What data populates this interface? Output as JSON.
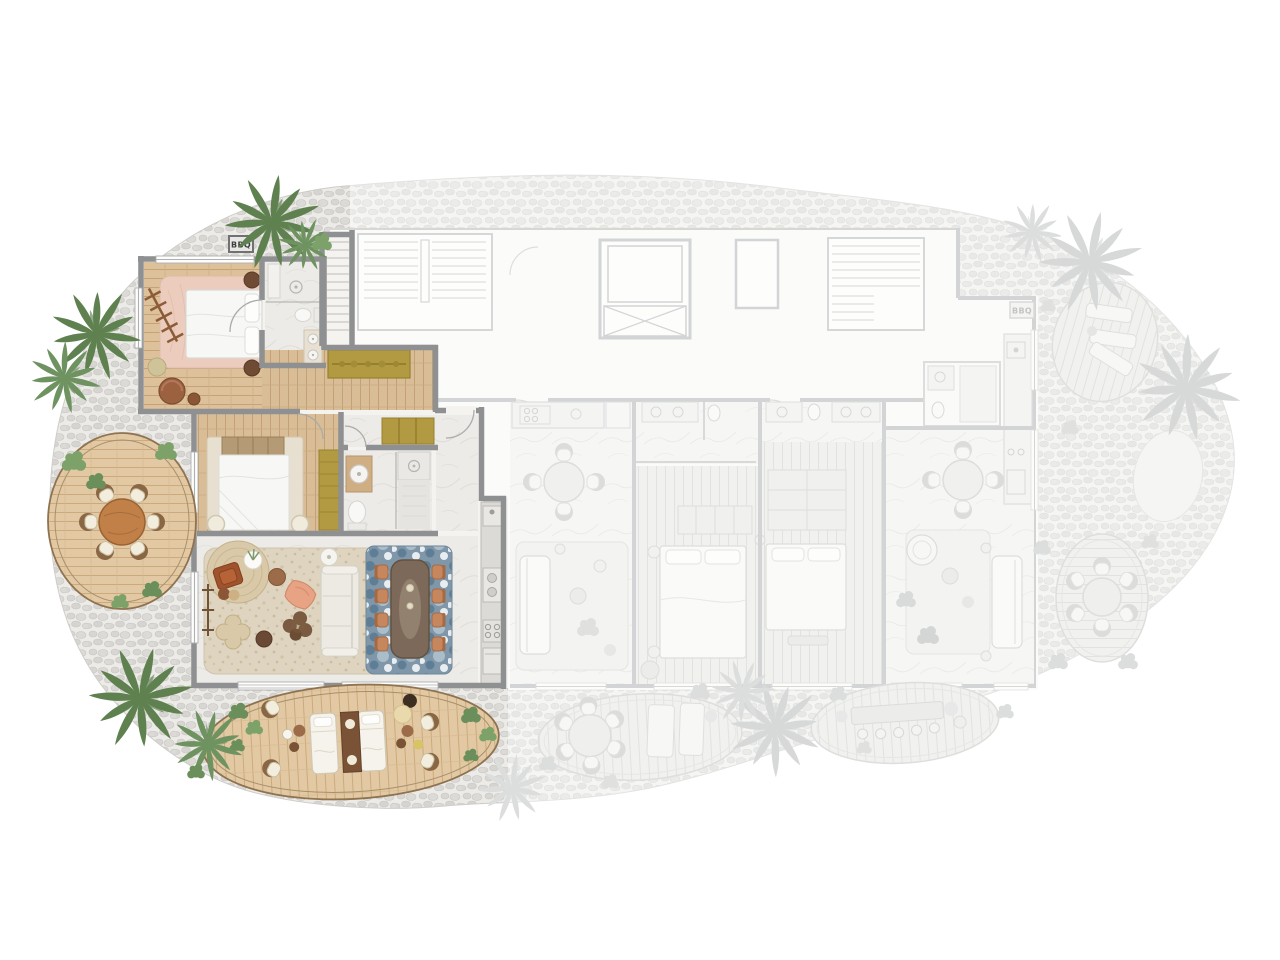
{
  "scene": {
    "type": "architectural floor plan",
    "view": "top-down",
    "description": "Resort residence floor plan: one highlighted corner suite with two bedrooms, two bathrooms, living-dining room, kitchen and two private wooden decks; adjacent units and circulation core shown grayed out."
  },
  "labels": {
    "bbq_left": "BBQ",
    "bbq_right": "BBQ"
  },
  "palette": {
    "wall": "#8e9091",
    "faded_wall": "#d2d4d5",
    "wood_floor": "#dcc19b",
    "deck_wood": "#e2c9a3",
    "marble": "#edebe7",
    "pebble_stone": "#d8d6d2",
    "faded_stone": "#e9e9e7",
    "rug_pink": "#eccdbd",
    "rug_beige": "#ded4c0",
    "rug_blue": "#7e97ab",
    "wardrobe_olive": "#b29a43",
    "chair_orange": "#c6875f",
    "table_walnut": "#7d695a",
    "palm_green": "#5f8150",
    "palm_faded": "#d7d9d8"
  },
  "highlighted_unit": {
    "rooms": [
      {
        "name": "Master bedroom",
        "furniture": [
          "double bed",
          "pink area rug",
          "two bedside tables",
          "lounge chair",
          "side table",
          "pouf",
          "decorative ladder"
        ]
      },
      {
        "name": "Master bathroom",
        "furniture": [
          "walk-in shower",
          "bench",
          "toilet",
          "double vanity"
        ]
      },
      {
        "name": "Dressing corridor",
        "furniture": [
          "olive wardrobe"
        ]
      },
      {
        "name": "Second bedroom",
        "furniture": [
          "double bed",
          "headboard cushions",
          "two round stools",
          "olive wardrobe"
        ]
      },
      {
        "name": "Second bathroom",
        "furniture": [
          "wood vanity with basin",
          "toilet",
          "shower with drain"
        ]
      },
      {
        "name": "Entry foyer",
        "furniture": [
          "olive closet"
        ]
      },
      {
        "name": "Living room",
        "furniture": [
          "cream sofa",
          "round jute rug",
          "rust armchair",
          "plant table",
          "floor lamp",
          "ottomans",
          "clover coffee tables",
          "wooden bench",
          "beige area rug"
        ]
      },
      {
        "name": "Dining area",
        "furniture": [
          "walnut dining table",
          "eight terracotta chairs",
          "blue area rug",
          "candles"
        ]
      },
      {
        "name": "Kitchen",
        "furniture": [
          "counter",
          "faucet station",
          "double sink",
          "cooktop",
          "oven"
        ]
      },
      {
        "name": "Private stair",
        "furniture": []
      }
    ],
    "outdoor": [
      {
        "name": "Round garden deck",
        "furniture": [
          "round dining table",
          "six chairs",
          "shrubs"
        ]
      },
      {
        "name": "Sun deck",
        "furniture": [
          "two sun loungers",
          "shared lounger table",
          "four lounge chairs",
          "side tables",
          "planters"
        ]
      },
      {
        "name": "BBQ corner",
        "label": "BBQ"
      }
    ]
  },
  "faded_area": {
    "core": [
      "staircase",
      "elevator",
      "service shaft",
      "second staircase",
      "corridor"
    ],
    "units": [
      {
        "name": "Middle unit",
        "features": [
          "kitchen counter with cooktop",
          "fridge",
          "round dining table with four chairs",
          "sofa with rug"
        ]
      },
      {
        "name": "Bedroom A",
        "features": [
          "wardrobe",
          "double bed",
          "bathroom with double sinks and toilet"
        ]
      },
      {
        "name": "Bedroom B",
        "features": [
          "closet",
          "double bed",
          "bathroom with double sinks and toilet",
          "bench"
        ]
      },
      {
        "name": "Corner unit",
        "features": [
          "round dining table with four chairs",
          "lounge chair",
          "sofa",
          "rug",
          "bathroom",
          "kitchen strip",
          "BBQ corner"
        ]
      }
    ],
    "outdoor": [
      "tilted wood terrace with three loungers",
      "plain oval terrace",
      "round-table deck with six chairs",
      "oval deck with round table and two loungers",
      "long-table deck with stools",
      "faded palm trees and shrubs"
    ]
  }
}
